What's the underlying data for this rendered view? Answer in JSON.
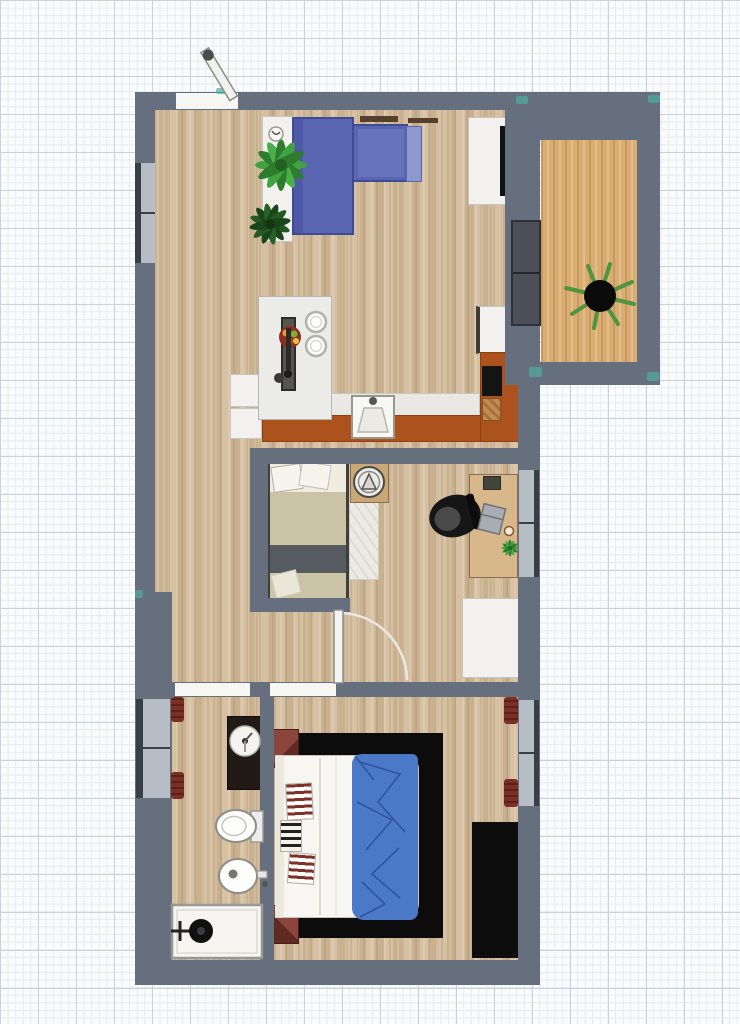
{
  "canvas": {
    "width": 740,
    "height": 1024,
    "kind": "2d-floor-plan-canvas",
    "grid": {
      "minor_px": 7.6,
      "major_px": 38
    }
  },
  "palette": {
    "wall": "#666f7d",
    "floor_wood": "#cfb899",
    "balcony_deck": "#d9ac72",
    "sofa_blue": "#5a66b2",
    "kitchen_terracotta": "#ac521d",
    "blanket_blue": "#4b79c8",
    "rug_black": "#0c0c0c",
    "nightstand_maroon": "#7d3c33",
    "plant_green": "#3fa33f",
    "window_pane": "#b7bdc5",
    "window_frame": "#3a3f46",
    "curtain_red": "#7b3027",
    "grid_major": "#c9d2d9",
    "grid_minor": "#e6ebee",
    "corner_marker_teal": "#4fae9e"
  },
  "items": {
    "entrance_door": "Entrance door (open leaf with knob)",
    "window_livingroom_left": "Window - living room left wall",
    "window_bathroom_left": "Window - bathroom left wall",
    "window_bedroom_mid_right": "Window - middle bedroom right wall",
    "window_bedroom_bottom_right": "Window - bottom bedroom right wall",
    "sliding_door_balcony": "Sliding door to balcony",
    "balcony_deck": "Balcony wooden deck",
    "balcony_plant": "Balcony potted plant",
    "sideboard": "White sideboard with plants",
    "plant_large": "Large green plant",
    "plant_small": "Small dark green plant",
    "pot_white": "Small white pot",
    "sofa": "Blue L-shaped sofa",
    "wall_art_1": "Wall shelf strip",
    "wall_art_2": "Wall shelf strip",
    "tv_stand": "White TV stand",
    "tv": "Flat TV on stand",
    "dining_table": "Dining table with two place settings",
    "table_runner": "Dark table runner with utensils",
    "fruit_bowl": "Bowl of fruit",
    "plate_1": "Plate setting 1",
    "plate_2": "Plate setting 2",
    "cup": "Cup",
    "kitchen_counter": "Kitchen counter run (terracotta)",
    "kitchen_counter_right": "Kitchen corner counter (terracotta)",
    "countertop": "White countertop",
    "kitchen_sink": "Kitchen sink",
    "cooktop": "Black cooktop",
    "cutting_board": "Wooden cutting board",
    "fridge": "White appliance / fridge",
    "base_cabinet_1": "White base cabinet",
    "base_cabinet_2": "White base cabinet",
    "bed_middle": "Single bed with beige blanket",
    "bed_middle_pillows": "Bed pillows",
    "rug_middle": "Light rug",
    "fan_table": "Side table with fan",
    "desk": "Wooden desk",
    "office_chair": "Black office chair",
    "laptop": "Laptop",
    "notebook": "Dark notebook",
    "desk_plant": "Small desk plant",
    "mug": "Mug",
    "dresser_white": "White dresser",
    "door_middle_bedroom": "Open interior door with swing arc",
    "vanity": "Dark bathroom vanity with round sink",
    "toilet": "Toilet",
    "bidet": "Bidet",
    "shower": "Shower tray with head and valve",
    "towel_rail_top": "Dark red curtain/towel rail",
    "towel_rail_bottom": "Dark red curtain/towel rail",
    "double_bed": "Double bed with white duvet",
    "blue_blanket": "Crumpled blue blanket",
    "striped_pillows": "Striped pillows at headboard",
    "nightstand_top": "Maroon nightstand",
    "nightstand_bottom": "Maroon nightstand",
    "rug_black": "Large black rug",
    "wardrobe": "Black wardrobe",
    "curtain_top": "Dark red curtain",
    "curtain_bottom": "Dark red curtain",
    "corner_marker": "Teal corner guide marker"
  }
}
